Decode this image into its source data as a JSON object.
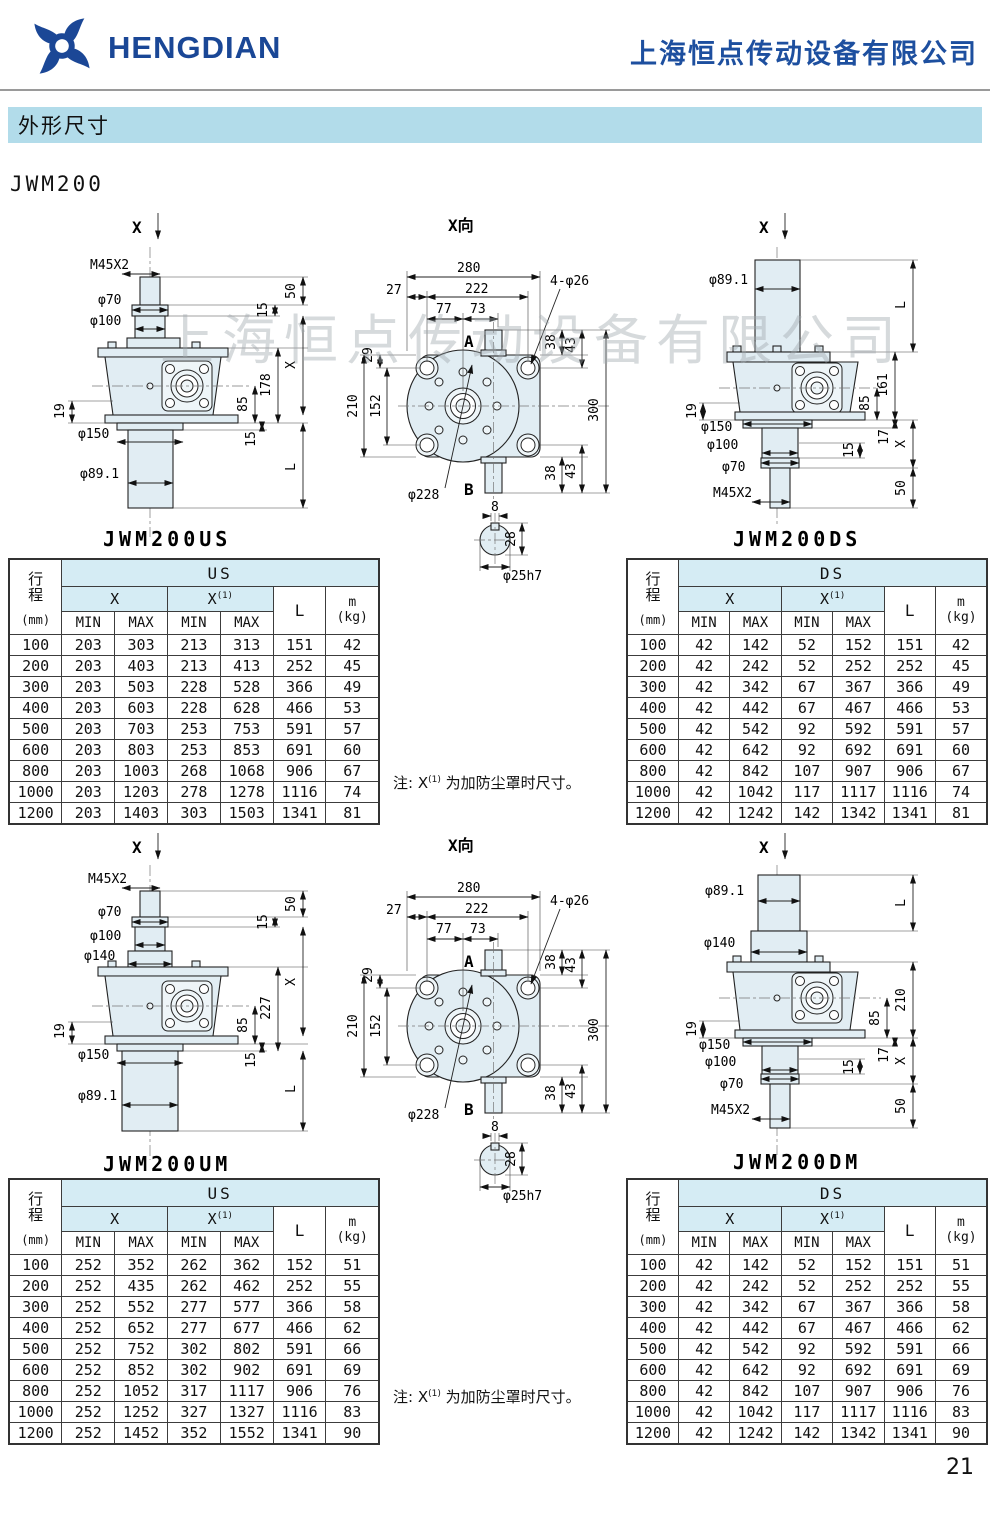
{
  "header": {
    "brand": "HENGDIAN",
    "company": "上海恒点传动设备有限公司"
  },
  "section_title": "外形尺寸",
  "model": "JWM200",
  "watermark": "上海恒点传动设备有限公司",
  "page_number": "21",
  "note": {
    "prefix": "注: X",
    "sup": "(1)",
    "suffix": " 为加防尘罩时尺寸。"
  },
  "colors": {
    "brand_blue": "#1a4796",
    "banner_blue": "#b2dcea",
    "table_header_cyan": "#d5ecf4",
    "part_fill": "#e1edf3"
  },
  "table_labels": {
    "stroke_l1": "行",
    "stroke_l2": "程",
    "stroke_unit": "(mm)",
    "x": "X",
    "x1_base": "X",
    "x1_sup": "(1)",
    "min": "MIN",
    "max": "MAX",
    "L": "L",
    "m": "m",
    "kg": "(kg)"
  },
  "tables": {
    "us_top": {
      "group": "US",
      "rows": [
        [
          "100",
          "203",
          "303",
          "213",
          "313",
          "151",
          "42"
        ],
        [
          "200",
          "203",
          "403",
          "213",
          "413",
          "252",
          "45"
        ],
        [
          "300",
          "203",
          "503",
          "228",
          "528",
          "366",
          "49"
        ],
        [
          "400",
          "203",
          "603",
          "228",
          "628",
          "466",
          "53"
        ],
        [
          "500",
          "203",
          "703",
          "253",
          "753",
          "591",
          "57"
        ],
        [
          "600",
          "203",
          "803",
          "253",
          "853",
          "691",
          "60"
        ],
        [
          "800",
          "203",
          "1003",
          "268",
          "1068",
          "906",
          "67"
        ],
        [
          "1000",
          "203",
          "1203",
          "278",
          "1278",
          "1116",
          "74"
        ],
        [
          "1200",
          "203",
          "1403",
          "303",
          "1503",
          "1341",
          "81"
        ]
      ]
    },
    "ds_top": {
      "group": "DS",
      "rows": [
        [
          "100",
          "42",
          "142",
          "52",
          "152",
          "151",
          "42"
        ],
        [
          "200",
          "42",
          "242",
          "52",
          "252",
          "252",
          "45"
        ],
        [
          "300",
          "42",
          "342",
          "67",
          "367",
          "366",
          "49"
        ],
        [
          "400",
          "42",
          "442",
          "67",
          "467",
          "466",
          "53"
        ],
        [
          "500",
          "42",
          "542",
          "92",
          "592",
          "591",
          "57"
        ],
        [
          "600",
          "42",
          "642",
          "92",
          "692",
          "691",
          "60"
        ],
        [
          "800",
          "42",
          "842",
          "107",
          "907",
          "906",
          "67"
        ],
        [
          "1000",
          "42",
          "1042",
          "117",
          "1117",
          "1116",
          "74"
        ],
        [
          "1200",
          "42",
          "1242",
          "142",
          "1342",
          "1341",
          "81"
        ]
      ]
    },
    "us_bottom": {
      "group": "US",
      "rows": [
        [
          "100",
          "252",
          "352",
          "262",
          "362",
          "152",
          "51"
        ],
        [
          "200",
          "252",
          "435",
          "262",
          "462",
          "252",
          "55"
        ],
        [
          "300",
          "252",
          "552",
          "277",
          "577",
          "366",
          "58"
        ],
        [
          "400",
          "252",
          "652",
          "277",
          "677",
          "466",
          "62"
        ],
        [
          "500",
          "252",
          "752",
          "302",
          "802",
          "591",
          "66"
        ],
        [
          "600",
          "252",
          "852",
          "302",
          "902",
          "691",
          "69"
        ],
        [
          "800",
          "252",
          "1052",
          "317",
          "1117",
          "906",
          "76"
        ],
        [
          "1000",
          "252",
          "1252",
          "327",
          "1327",
          "1116",
          "83"
        ],
        [
          "1200",
          "252",
          "1452",
          "352",
          "1552",
          "1341",
          "90"
        ]
      ]
    },
    "ds_bottom": {
      "group": "DS",
      "rows": [
        [
          "100",
          "42",
          "142",
          "52",
          "152",
          "151",
          "51"
        ],
        [
          "200",
          "42",
          "242",
          "52",
          "252",
          "252",
          "55"
        ],
        [
          "300",
          "42",
          "342",
          "67",
          "367",
          "366",
          "58"
        ],
        [
          "400",
          "42",
          "442",
          "67",
          "467",
          "466",
          "62"
        ],
        [
          "500",
          "42",
          "542",
          "92",
          "592",
          "591",
          "66"
        ],
        [
          "600",
          "42",
          "642",
          "92",
          "692",
          "691",
          "69"
        ],
        [
          "800",
          "42",
          "842",
          "107",
          "907",
          "906",
          "76"
        ],
        [
          "1000",
          "42",
          "1042",
          "117",
          "1117",
          "1116",
          "83"
        ],
        [
          "1200",
          "42",
          "1242",
          "142",
          "1342",
          "1341",
          "90"
        ]
      ]
    }
  },
  "drawings": {
    "us": {
      "caption": "JWM200US",
      "xarrow": "X",
      "m45": "M45X2",
      "d70": "φ70",
      "d100": "φ100",
      "d150": "φ150",
      "d89": "φ89.1",
      "n19": "19",
      "n50": "50",
      "n15t": "15",
      "x": "X",
      "h": "178",
      "n85": "85",
      "n15b": "15",
      "L": "L"
    },
    "um": {
      "caption": "JWM200UM",
      "xarrow": "X",
      "m45": "M45X2",
      "d70": "φ70",
      "d100": "φ100",
      "d140": "φ140",
      "d150": "φ150",
      "d89": "φ89.1",
      "n19": "19",
      "n50": "50",
      "n15t": "15",
      "x": "X",
      "h": "227",
      "n85": "85",
      "n15b": "15",
      "L": "L"
    },
    "ds": {
      "caption": "JWM200DS",
      "xarrow": "X",
      "d89": "φ89.1",
      "L": "L",
      "h": "161",
      "n85": "85",
      "n17": "17",
      "n15": "15",
      "x": "X",
      "n50": "50",
      "d150": "φ150",
      "d100": "φ100",
      "d70": "φ70",
      "m45": "M45X2",
      "n19": "19"
    },
    "dm": {
      "caption": "JWM200DM",
      "xarrow": "X",
      "d89": "φ89.1",
      "d140": "φ140",
      "L": "L",
      "h": "210",
      "n85": "85",
      "n17": "17",
      "n15": "15",
      "x": "X",
      "n50": "50",
      "d150": "φ150",
      "d100": "φ100",
      "d70": "φ70",
      "m45": "M45X2",
      "n19": "19"
    },
    "xview": {
      "title": "X向",
      "n280": "280",
      "n27": "27",
      "n222": "222",
      "n77": "77",
      "n73": "73",
      "holes": "4-φ26",
      "n29": "29",
      "n38": "38",
      "n43": "43",
      "n210": "210",
      "n152": "152",
      "n300": "300",
      "d228": "φ228",
      "a": "A",
      "b": "B",
      "n8": "8",
      "n28": "28",
      "d25": "φ25h7"
    }
  }
}
